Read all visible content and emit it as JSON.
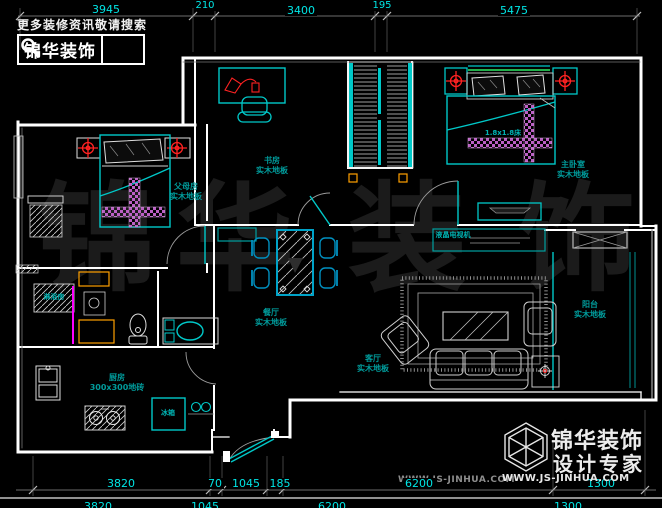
{
  "colors": {
    "background": "#000000",
    "walls": "#ffffff",
    "fixtures_cyan": "#00c8c8",
    "dimension_text": "#00e5e5",
    "room_label_teal": "#009c9c",
    "symbol_red": "#ff2222",
    "carpet_magenta": "#bb5fc4",
    "glass_magenta": "#ff00ff",
    "cabinet_orange": "#ffa000",
    "headboard_green": "#22b14c",
    "dim_line_gray": "#8f8f8f",
    "watermark_gray": "#1b1b1b"
  },
  "header": {
    "tagline": "更多装修资讯敬请搜索",
    "brand": "锦华装饰",
    "search_icon": "magnifier"
  },
  "dims": {
    "top": [
      "3945",
      "210",
      "3400",
      "195",
      "5475"
    ],
    "bottom": [
      "3820",
      "70",
      "1045",
      "185",
      "6200",
      "1300"
    ],
    "bottom2": [
      "3820",
      "1045",
      "6200",
      "1300"
    ]
  },
  "rooms": {
    "parents": {
      "name": "父母房",
      "floor": "实木地板"
    },
    "study": {
      "name": "书房",
      "floor": "实木地板"
    },
    "master": {
      "name": "主卧室",
      "floor": "实木地板"
    },
    "dining": {
      "name": "餐厅",
      "floor": "实木地板"
    },
    "living": {
      "name": "客厅",
      "floor": "实木地板"
    },
    "balcony": {
      "name": "阳台",
      "floor": "实木地板"
    },
    "kitchen": {
      "name": "厨房",
      "floor": "300x300地砖"
    }
  },
  "fixtures": {
    "shower": "淋浴房",
    "fridge": "冰箱",
    "tv": "液晶电视机",
    "master_bed": "1.8x1.8床"
  },
  "logo": {
    "brand": "锦华装饰",
    "subtitle": "设计专家",
    "website": "WWW.JS-JINHUA.COM",
    "icon": "wireframe-cube"
  },
  "watermark": {
    "chars": [
      "锦",
      "华",
      "装",
      "饰"
    ],
    "website": "WWW.JS-JINHUA.COM"
  }
}
